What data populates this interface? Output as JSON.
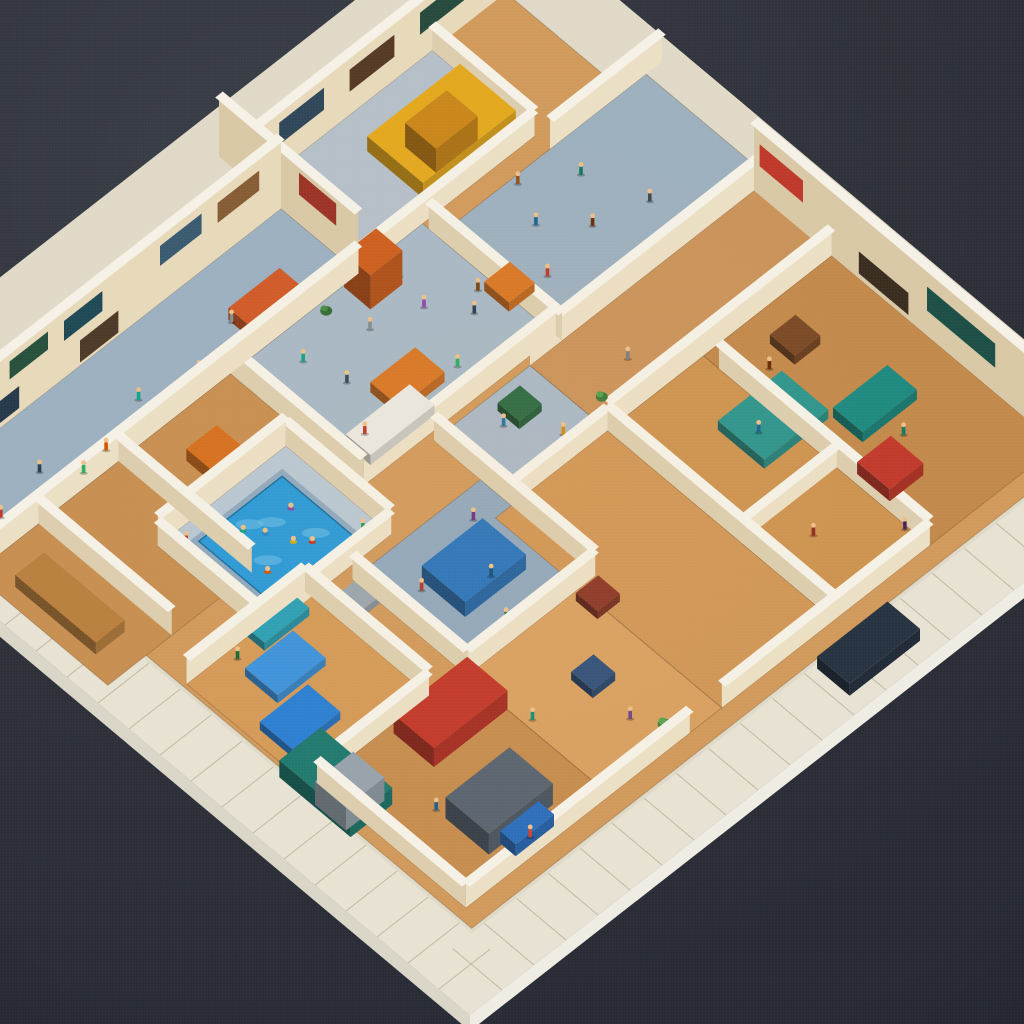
{
  "meta": {
    "description": "Photograph-style render of a miniature isometric diorama: a square cutaway building model on a white tiled base over a dark charcoal surface, packed with cream-walled rooms, tan wood floors, blue-gray halls, a swimming pool with swimmers, a yellow vehicle in a top garage, colorful tiny figures and furniture.",
    "type": "natural-image"
  },
  "background": {
    "light": "#3b3f48",
    "base": "#2d3038",
    "dark": "#222530"
  },
  "scene": {
    "origin": [
      470,
      1015
    ],
    "axis_a": [
      32,
      -25
    ],
    "axis_b": [
      -31,
      -26
    ],
    "size": 22,
    "plate": {
      "top": "#e0d9c8",
      "rim": "#e8e2d3",
      "seam": "#c0b7a3",
      "side_right": "#efece3",
      "side_left": "#d9d5c7",
      "edge_height": 16,
      "inner_border": "#c4b89e"
    },
    "palette": {
      "wall_face_a": "#ebdfc4",
      "wall_face_b": "#dbcdad",
      "wall_far": "#e7d9ba",
      "wall_far_b": "#d8c8a6",
      "cap": "#f5f1e6",
      "skin": "#ecc089",
      "floor_line": "rgba(90,60,30,0.28)"
    },
    "floors": [
      [
        "interior-base",
        1.7,
        1.7,
        20.3,
        20.3,
        "#d19a5c"
      ],
      [
        "left-rooms",
        0.5,
        12.2,
        8.5,
        16.5,
        "#c78f51"
      ],
      [
        "tl-hall",
        8.5,
        12.2,
        14.5,
        16.5,
        "#a7b8c5"
      ],
      [
        "tl-upper-hall",
        0.5,
        16.5,
        12.5,
        19.0,
        "#9cb0c0"
      ],
      [
        "corridor-top",
        14.5,
        12.0,
        21.0,
        16.0,
        "#9db0be"
      ],
      [
        "garage",
        12.5,
        16.5,
        18.0,
        19.8,
        "#b5bfc8"
      ],
      [
        "pool-deck",
        4.0,
        10.8,
        8.0,
        14.2,
        "#b9c7d2"
      ],
      [
        "courtyard",
        6.5,
        6.8,
        10.5,
        10.5,
        "#92a8bb"
      ],
      [
        "kids-room",
        10.5,
        9.5,
        13.5,
        12.0,
        "#a9b8c5"
      ],
      [
        "bedrooms",
        1.8,
        7.0,
        5.5,
        11.0,
        "#d49a58"
      ],
      [
        "shop-sw",
        2.0,
        2.2,
        6.5,
        7.0,
        "#c68d4f"
      ],
      [
        "bottom-mid",
        6.5,
        2.2,
        10.0,
        6.8,
        "#d8a161"
      ],
      [
        "center-south",
        10.0,
        2.2,
        13.5,
        9.5,
        "#d09757"
      ],
      [
        "right-wing-a",
        13.5,
        2.2,
        16.5,
        9.5,
        "#cd9350"
      ],
      [
        "right-wing-b",
        16.5,
        2.2,
        20.5,
        9.5,
        "#c2894b"
      ],
      [
        "right-band",
        13.5,
        9.5,
        21.0,
        12.0,
        "#c9935a"
      ]
    ],
    "pool": {
      "lip": [
        4.6,
        11.2,
        7.5,
        13.8
      ],
      "lip_fill": "#8fa9bd",
      "water": [
        4.75,
        11.35,
        7.35,
        13.65
      ],
      "fill": "#2d9ad6",
      "ripple_fill": "#6fc0e6",
      "ripples": [
        [
          5.5,
          12.2
        ],
        [
          6.3,
          12.9
        ],
        [
          6.8,
          12.0
        ],
        [
          5.9,
          13.2
        ]
      ]
    },
    "walls": [
      [
        0,
        16.5,
        12.5,
        16.5,
        30,
        "i"
      ],
      [
        12.5,
        16.5,
        12.5,
        21,
        62,
        "f"
      ],
      [
        12.5,
        19.8,
        21.5,
        19.8,
        62,
        "f"
      ],
      [
        0,
        19,
        12.5,
        19,
        72,
        "f"
      ],
      [
        20.5,
        0.5,
        20.5,
        12,
        70,
        "f"
      ],
      [
        13.5,
        12,
        21,
        12,
        30,
        "i"
      ],
      [
        8.5,
        12.2,
        14.5,
        12.2,
        28,
        "i"
      ],
      [
        8.5,
        12.2,
        8.5,
        16.5,
        28,
        "i"
      ],
      [
        14.5,
        12,
        14.5,
        16.3,
        28,
        "i"
      ],
      [
        4,
        10.8,
        8,
        10.8,
        24,
        "i"
      ],
      [
        4,
        10.8,
        4,
        14.2,
        26,
        "i"
      ],
      [
        8,
        10.8,
        8,
        14.2,
        26,
        "i"
      ],
      [
        4,
        14.2,
        8,
        14.2,
        30,
        "i"
      ],
      [
        6.5,
        6.8,
        10.5,
        6.8,
        26,
        "i"
      ],
      [
        6.5,
        6.8,
        6.5,
        10.5,
        26,
        "i"
      ],
      [
        10.5,
        6.8,
        10.5,
        12,
        26,
        "i"
      ],
      [
        1.8,
        11,
        5.5,
        11,
        26,
        "i"
      ],
      [
        5.5,
        7,
        5.5,
        11,
        26,
        "i"
      ],
      [
        1.8,
        7,
        5.5,
        7,
        24,
        "i"
      ],
      [
        2,
        2.2,
        9,
        2.2,
        24,
        "i"
      ],
      [
        10,
        2.2,
        16.5,
        2.2,
        24,
        "i"
      ],
      [
        2,
        2.2,
        2,
        7,
        24,
        "i"
      ],
      [
        13.5,
        2.2,
        13.5,
        9.5,
        26,
        "i"
      ],
      [
        13.5,
        9.5,
        20.5,
        9.5,
        28,
        "i"
      ],
      [
        16.5,
        2.2,
        16.5,
        9,
        26,
        "i"
      ],
      [
        13.5,
        5.2,
        16.5,
        5.2,
        22,
        "i"
      ],
      [
        2.5,
        12.2,
        2.5,
        16.5,
        26,
        "i"
      ],
      [
        5.0,
        12.2,
        5.0,
        16.5,
        26,
        "i"
      ],
      [
        10.5,
        9.5,
        13.5,
        9.5,
        24,
        "i"
      ],
      [
        18,
        16,
        21.5,
        16,
        30,
        "i"
      ],
      [
        12.5,
        16.5,
        18,
        16.5,
        26,
        "i"
      ],
      [
        18,
        16.5,
        18,
        19.8,
        26,
        "i"
      ]
    ],
    "decor": [
      [
        3,
        0.4,
        1.9,
        40,
        58,
        "#e2bd22",
        "#bb3a2a"
      ],
      [
        3,
        2.3,
        3.6,
        42,
        62,
        "#2d5b45",
        null
      ],
      [
        3,
        4.0,
        5.2,
        42,
        60,
        "#27503d",
        null
      ],
      [
        3,
        1.0,
        2.2,
        8,
        30,
        "#5d4630",
        null
      ],
      [
        3,
        3.0,
        4.3,
        6,
        28,
        "#26394b",
        null
      ],
      [
        3,
        5.7,
        6.9,
        38,
        58,
        "#1f4a55",
        null
      ],
      [
        3,
        6.2,
        7.4,
        4,
        26,
        "#4e3a28",
        null
      ],
      [
        3,
        8.7,
        10.0,
        38,
        58,
        "#3a5a70",
        null
      ],
      [
        3,
        10.5,
        11.8,
        36,
        56,
        "#865c35",
        null
      ],
      [
        2,
        13.2,
        14.6,
        26,
        48,
        "#30475a",
        null
      ],
      [
        2,
        15.4,
        16.8,
        24,
        46,
        "#553a26",
        null
      ],
      [
        2,
        17.6,
        19.0,
        26,
        48,
        "#274a3c",
        null
      ],
      [
        4,
        10.4,
        11.8,
        30,
        52,
        "#bf392b",
        null
      ],
      [
        4,
        4.2,
        6.4,
        26,
        50,
        "#1c4f46",
        null
      ],
      [
        4,
        7.0,
        8.6,
        6,
        28,
        "#3a2d20",
        null
      ],
      [
        4,
        1.2,
        2.8,
        26,
        48,
        "#26394b",
        null
      ],
      [
        1,
        17.2,
        18.4,
        30,
        52,
        "#9b3326",
        null
      ]
    ],
    "boxes": [
      [
        "vehicle-yellow",
        15.0,
        17.0,
        2.9,
        1.8,
        15,
        "#e3a81e"
      ],
      [
        "vehicle-cab",
        15.7,
        17.3,
        1.3,
        1.0,
        24,
        "#c9861a"
      ],
      [
        "truck-teal",
        1.5,
        5.4,
        1.3,
        2.3,
        17,
        "#227a6e"
      ],
      [
        "truck-roof",
        1.55,
        5.6,
        1.2,
        1.0,
        23,
        "#97a2ab"
      ],
      [
        "roof-red",
        4.2,
        5.5,
        2.3,
        1.3,
        19,
        "#c23a2b"
      ],
      [
        "kiosk",
        3.4,
        2.9,
        2.0,
        1.4,
        21,
        "#5c6670"
      ],
      [
        "kiosk-front",
        3.8,
        2.45,
        1.2,
        0.5,
        12,
        "#2f6fba"
      ],
      [
        "bed-1",
        2.1,
        7.9,
        1.5,
        1.05,
        8,
        "#2d7fd2"
      ],
      [
        "bed-2",
        2.9,
        9.2,
        1.5,
        1.05,
        8,
        "#3f93da"
      ],
      [
        "bed-3",
        3.7,
        10.45,
        1.4,
        1.0,
        8,
        "#2da0b4"
      ],
      [
        "tent-blue",
        7.6,
        8.0,
        1.9,
        1.4,
        15,
        "#2e76ba"
      ],
      [
        "glass-table",
        15.3,
        6.3,
        2.0,
        1.5,
        9,
        "#2f958c"
      ],
      [
        "sofa-teal",
        17.4,
        5.3,
        1.7,
        0.95,
        10,
        "#1e8a80"
      ],
      [
        "armchair-red",
        16.7,
        3.7,
        1.05,
        1.05,
        12,
        "#c13a2c"
      ],
      [
        "desk-orange",
        10.4,
        13.0,
        1.4,
        0.95,
        10,
        "#d77726"
      ],
      [
        "counter-white",
        9.0,
        12.5,
        2.0,
        0.8,
        10,
        "#e9e7e0"
      ],
      [
        "car-dark",
        12.3,
        0.45,
        2.2,
        1.05,
        12,
        "#273341"
      ],
      [
        "locker-orange",
        12.0,
        15.6,
        1.0,
        0.85,
        34,
        "#cc5e1e"
      ],
      [
        "couch-orange",
        9.5,
        16.8,
        1.6,
        0.8,
        12,
        "#cf5a28"
      ],
      [
        "crate-orange",
        6.1,
        14.5,
        0.95,
        0.95,
        12,
        "#d5701f"
      ],
      [
        "crate-red",
        9.7,
        5.9,
        0.7,
        0.7,
        8,
        "#8e3b2a"
      ],
      [
        "crate-green",
        12.1,
        10.9,
        0.7,
        0.7,
        8,
        "#2d6b43"
      ],
      [
        "crate-brown",
        17.8,
        7.9,
        0.8,
        0.8,
        9,
        "#7a4a26"
      ],
      [
        "crate-gray",
        5.9,
        9.6,
        0.7,
        0.7,
        7,
        "#9aa5ad"
      ],
      [
        "crate-orange-2",
        14.2,
        13.4,
        0.8,
        0.8,
        9,
        "#d77726"
      ],
      [
        "crate-navy",
        8.1,
        4.4,
        0.7,
        0.7,
        8,
        "#35537a"
      ],
      [
        "bench-left",
        0.9,
        13.0,
        0.9,
        2.6,
        12,
        "#b9803f"
      ]
    ],
    "plants": [
      [
        12.9,
        16.1,
        8,
        "#3e7a3a"
      ],
      [
        8.7,
        2.7,
        7,
        "#457f3e"
      ],
      [
        17.8,
        9.6,
        7,
        "#3a7440"
      ],
      [
        6.1,
        2.5,
        6,
        "#4c8a46"
      ],
      [
        11.2,
        16.2,
        6,
        "#356b34"
      ],
      [
        14.0,
        10.2,
        6,
        "#3e7a3a"
      ]
    ],
    "figures": [
      [
        9.5,
        13.2,
        "#c0392b"
      ],
      [
        10.2,
        14.5,
        "#34495e"
      ],
      [
        11.0,
        13.8,
        "#d35400"
      ],
      [
        11.6,
        15.2,
        "#7f8c8d"
      ],
      [
        12.3,
        13.1,
        "#27ae60"
      ],
      [
        12.9,
        14.8,
        "#8e44ad"
      ],
      [
        13.6,
        13.9,
        "#2c3e50"
      ],
      [
        10.7,
        12.6,
        "#e67e22"
      ],
      [
        9.9,
        15.6,
        "#16a085"
      ],
      [
        13.1,
        15.8,
        "#b03a2e"
      ],
      [
        12.0,
        12.4,
        "#5d6d7e"
      ],
      [
        14.1,
        14.3,
        "#784212"
      ],
      [
        15.5,
        13.5,
        "#c0392b"
      ],
      [
        16.3,
        14.7,
        "#1f618d"
      ],
      [
        17.2,
        13.8,
        "#6e2c00"
      ],
      [
        18.0,
        15.0,
        "#117864"
      ],
      [
        18.6,
        13.4,
        "#424949"
      ],
      [
        16.8,
        15.8,
        "#935116"
      ],
      [
        4.5,
        13.8,
        "#c0392b"
      ],
      [
        7.6,
        11.3,
        "#239b56"
      ],
      [
        7.4,
        9.2,
        "#b03a2e"
      ],
      [
        8.8,
        8.4,
        "#1a5276"
      ],
      [
        9.6,
        9.8,
        "#6c3483"
      ],
      [
        8.2,
        7.3,
        "#196f3d"
      ],
      [
        10.8,
        10.4,
        "#cb4335"
      ],
      [
        11.9,
        11.2,
        "#2874a6"
      ],
      [
        12.7,
        10.1,
        "#d68910"
      ],
      [
        14.8,
        4.2,
        "#922b21"
      ],
      [
        15.9,
        7.1,
        "#1f618d"
      ],
      [
        17.3,
        8.2,
        "#6e2c00"
      ],
      [
        18.2,
        4.8,
        "#117a65"
      ],
      [
        16.4,
        2.9,
        "#4a235a"
      ],
      [
        15.2,
        10.6,
        "#7b7d7d"
      ],
      [
        3.4,
        4.6,
        "#21618c"
      ],
      [
        5.1,
        3.2,
        "#9c640c"
      ],
      [
        6.7,
        4.9,
        "#148f77"
      ],
      [
        8.3,
        3.4,
        "#76448a"
      ],
      [
        4.4,
        2.6,
        "#cb4335"
      ],
      [
        2.6,
        7.6,
        "#1a5276"
      ],
      [
        4.2,
        9.8,
        "#873600"
      ],
      [
        3.1,
        10.7,
        "#186a3b"
      ],
      [
        2.0,
        17.2,
        "#c0392b"
      ],
      [
        3.5,
        17.5,
        "#2c3e50"
      ],
      [
        5.0,
        16.9,
        "#d35400"
      ],
      [
        6.5,
        17.4,
        "#16a085"
      ],
      [
        8.0,
        17.0,
        "#8e44ad"
      ],
      [
        9.5,
        17.5,
        "#7f8c8d"
      ],
      [
        4.2,
        16.8,
        "#27ae60"
      ]
    ],
    "swimmers": [
      [
        5.3,
        12.0,
        "#d35400"
      ],
      [
        6.0,
        12.8,
        "#2e86c1"
      ],
      [
        6.6,
        11.9,
        "#c0392b"
      ],
      [
        5.7,
        13.2,
        "#16a085"
      ],
      [
        6.9,
        12.9,
        "#884ea0"
      ],
      [
        6.3,
        12.2,
        "#d4ac0d"
      ]
    ]
  }
}
